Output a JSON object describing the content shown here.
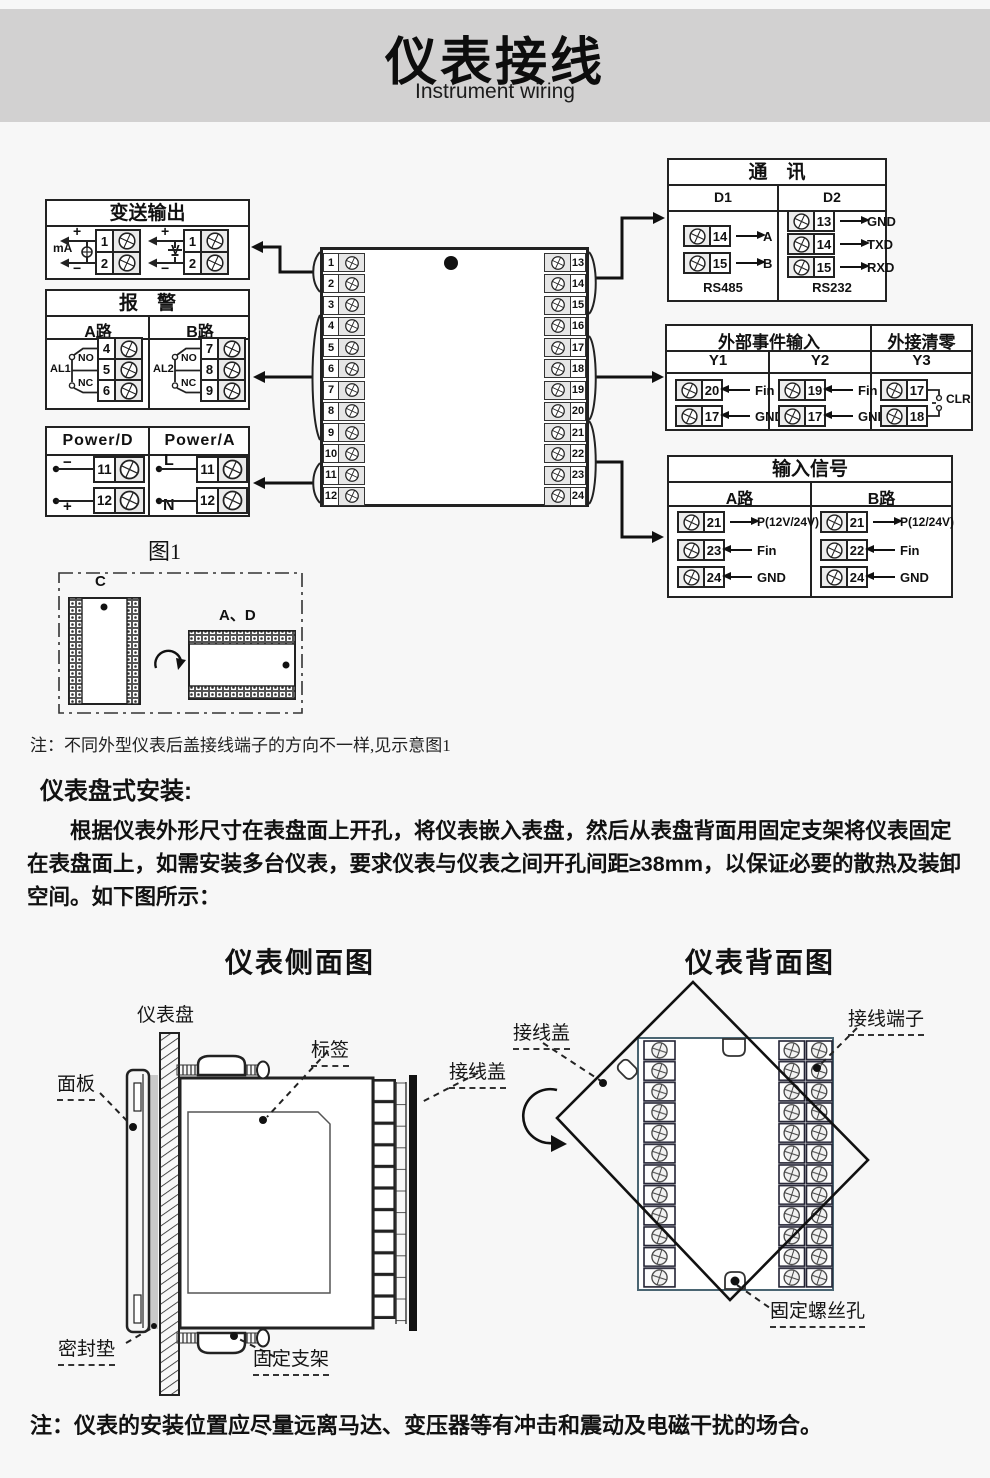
{
  "header": {
    "title": "仪表接线",
    "subtitle": "Instrument wiring"
  },
  "transmitter": {
    "title": "变送输出",
    "ma_label": "mA",
    "v_label": "V",
    "ma_plus": "+",
    "ma_minus": "−",
    "v_plus": "+",
    "v_minus": "−",
    "ma_t1": "1",
    "ma_t2": "2",
    "v_t1": "1",
    "v_t2": "2"
  },
  "alarm": {
    "title": "报　警",
    "route_a": "A路",
    "route_b": "B路",
    "al1": "AL1",
    "al2": "AL2",
    "no_a": "NO",
    "nc_a": "NC",
    "no_b": "NO",
    "nc_b": "NC",
    "a_terms": [
      "4",
      "5",
      "6"
    ],
    "b_terms": [
      "7",
      "8",
      "9"
    ]
  },
  "power": {
    "d_title": "Power/D",
    "a_title": "Power/A",
    "minus": "−",
    "plus": "+",
    "l": "L",
    "n": "N",
    "d_t1": "11",
    "d_t2": "12",
    "a_t1": "11",
    "a_t2": "12"
  },
  "center": {
    "left": [
      "1",
      "2",
      "3",
      "4",
      "5",
      "6",
      "7",
      "8",
      "9",
      "10",
      "11",
      "12"
    ],
    "right": [
      "13",
      "14",
      "15",
      "16",
      "17",
      "18",
      "19",
      "20",
      "21",
      "22",
      "23",
      "24"
    ]
  },
  "comm": {
    "title": "通　讯",
    "d1": "D1",
    "d2": "D2",
    "rs485": "RS485",
    "rs232": "RS232",
    "d1_rows": [
      {
        "t": "14",
        "s": "A"
      },
      {
        "t": "15",
        "s": "B"
      }
    ],
    "d2_rows": [
      {
        "t": "13",
        "s": "GND"
      },
      {
        "t": "14",
        "s": "TXD"
      },
      {
        "t": "15",
        "s": "RXD"
      }
    ]
  },
  "event": {
    "title": "外部事件输入",
    "clear_title": "外接清零",
    "y1": "Y1",
    "y2": "Y2",
    "y3": "Y3",
    "y1_rows": [
      {
        "t": "20",
        "s": "Fin"
      },
      {
        "t": "17",
        "s": "GND"
      }
    ],
    "y2_rows": [
      {
        "t": "19",
        "s": "Fin"
      },
      {
        "t": "17",
        "s": "GND"
      }
    ],
    "y3_t1": "17",
    "y3_t2": "18",
    "clr": "CLR"
  },
  "input": {
    "title": "输入信号",
    "route_a": "A路",
    "route_b": "B路",
    "a_rows": [
      {
        "t": "21",
        "s": "P(12V/24V)"
      },
      {
        "t": "23",
        "s": "Fin"
      },
      {
        "t": "24",
        "s": "GND"
      }
    ],
    "b_rows": [
      {
        "t": "21",
        "s": "P(12/24V)"
      },
      {
        "t": "22",
        "s": "Fin"
      },
      {
        "t": "24",
        "s": "GND"
      }
    ]
  },
  "fig1": {
    "title": "图1",
    "c_label": "C",
    "ad_label": "A、D"
  },
  "notes": {
    "note1": "注：不同外型仪表后盖接线端子的方向不一样,见示意图1",
    "note2": "注：仪表的安装位置应尽量远离马达、变压器等有冲击和震动及电磁干扰的场合。"
  },
  "install": {
    "heading": "仪表盘式安装:",
    "para": "根据仪表外形尺寸在表盘面上开孔，将仪表嵌入表盘，然后从表盘背面用固定支架将仪表固定在表盘面上，如需安装多台仪表，要求仪表与仪表之间开孔间距≥38mm，以保证必要的散热及装卸空间。如下图所示："
  },
  "side_view": {
    "heading": "仪表侧面图",
    "panel": "仪表盘",
    "front": "面板",
    "tag": "标签",
    "cover": "接线盖",
    "gasket": "密封垫",
    "bracket": "固定支架"
  },
  "back_view": {
    "heading": "仪表背面图",
    "cover": "接线盖",
    "terminal": "接线端子",
    "screw_hole": "固定螺丝孔"
  },
  "colors": {
    "line": "#1a1a1a",
    "bg": "#f7f7f7",
    "header_bg": "#d2d1d1"
  }
}
